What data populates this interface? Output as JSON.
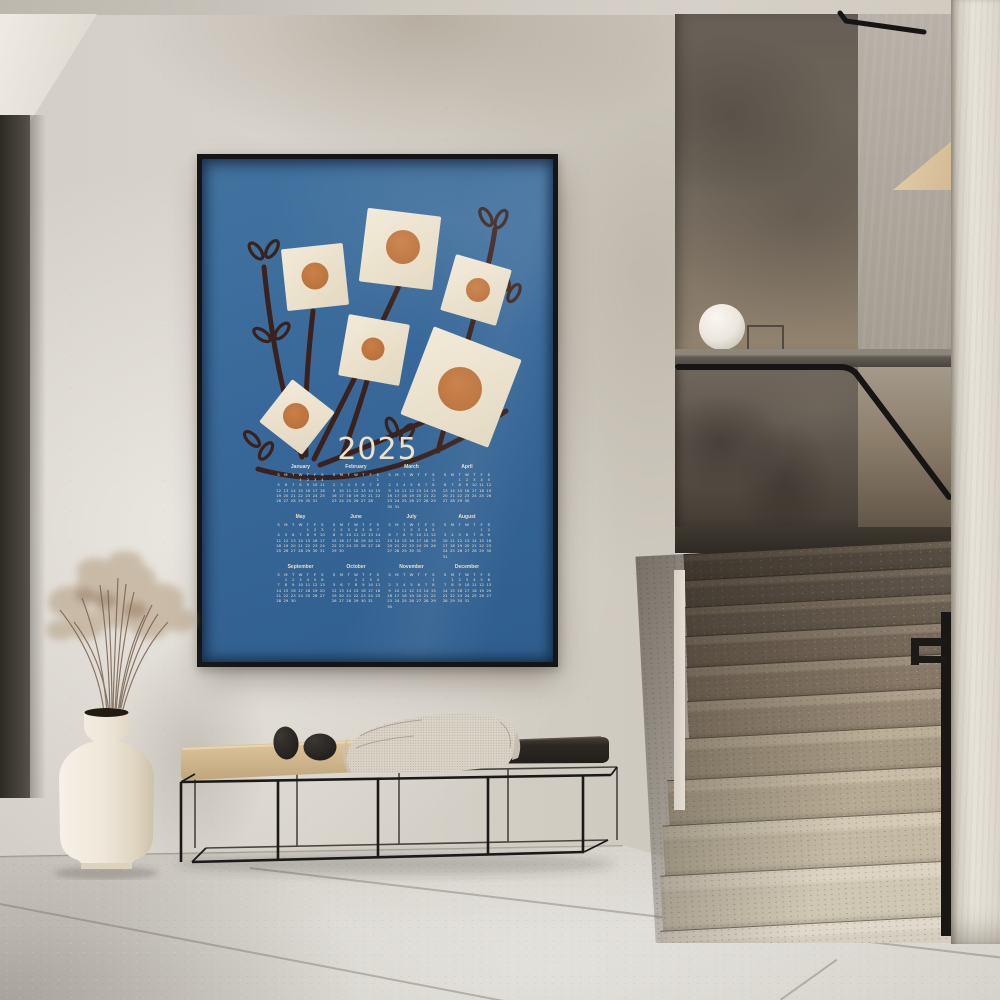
{
  "poster": {
    "title": "2025",
    "colors": {
      "poster_background": "#38699b",
      "flower_square": "#ece3d0",
      "flower_dot": "#c0763e",
      "branch": "#3a211b",
      "text": "#ece2cc",
      "frame": "#151518"
    },
    "calendar": {
      "day_headers": [
        "S",
        "M",
        "T",
        "W",
        "T",
        "F",
        "S"
      ],
      "months": [
        {
          "name": "January",
          "weeks": [
            [
              "",
              "",
              "",
              "1",
              "2",
              "3",
              "4"
            ],
            [
              "5",
              "6",
              "7",
              "8",
              "9",
              "10",
              "11"
            ],
            [
              "12",
              "13",
              "14",
              "15",
              "16",
              "17",
              "18"
            ],
            [
              "19",
              "20",
              "21",
              "22",
              "23",
              "24",
              "25"
            ],
            [
              "26",
              "27",
              "28",
              "29",
              "30",
              "31",
              ""
            ]
          ]
        },
        {
          "name": "February",
          "weeks": [
            [
              "",
              "",
              "",
              "",
              "",
              "",
              "1"
            ],
            [
              "2",
              "3",
              "4",
              "5",
              "6",
              "7",
              "8"
            ],
            [
              "9",
              "10",
              "11",
              "12",
              "13",
              "14",
              "15"
            ],
            [
              "16",
              "17",
              "18",
              "19",
              "20",
              "21",
              "22"
            ],
            [
              "23",
              "24",
              "25",
              "26",
              "27",
              "28",
              ""
            ]
          ]
        },
        {
          "name": "March",
          "weeks": [
            [
              "",
              "",
              "",
              "",
              "",
              "",
              "1"
            ],
            [
              "2",
              "3",
              "4",
              "5",
              "6",
              "7",
              "8"
            ],
            [
              "9",
              "10",
              "11",
              "12",
              "13",
              "14",
              "15"
            ],
            [
              "16",
              "17",
              "18",
              "19",
              "20",
              "21",
              "22"
            ],
            [
              "23",
              "24",
              "25",
              "26",
              "27",
              "28",
              "29"
            ],
            [
              "30",
              "31",
              "",
              "",
              "",
              "",
              ""
            ]
          ]
        },
        {
          "name": "April",
          "weeks": [
            [
              "",
              "",
              "1",
              "2",
              "3",
              "4",
              "5"
            ],
            [
              "6",
              "7",
              "8",
              "9",
              "10",
              "11",
              "12"
            ],
            [
              "13",
              "14",
              "15",
              "16",
              "17",
              "18",
              "19"
            ],
            [
              "20",
              "21",
              "22",
              "23",
              "24",
              "25",
              "26"
            ],
            [
              "27",
              "28",
              "29",
              "30",
              "",
              "",
              ""
            ]
          ]
        },
        {
          "name": "May",
          "weeks": [
            [
              "",
              "",
              "",
              "",
              "1",
              "2",
              "3"
            ],
            [
              "4",
              "5",
              "6",
              "7",
              "8",
              "9",
              "10"
            ],
            [
              "11",
              "12",
              "13",
              "14",
              "15",
              "16",
              "17"
            ],
            [
              "18",
              "19",
              "20",
              "21",
              "22",
              "23",
              "24"
            ],
            [
              "25",
              "26",
              "27",
              "28",
              "29",
              "30",
              "31"
            ]
          ]
        },
        {
          "name": "June",
          "weeks": [
            [
              "1",
              "2",
              "3",
              "4",
              "5",
              "6",
              "7"
            ],
            [
              "8",
              "9",
              "10",
              "11",
              "12",
              "13",
              "14"
            ],
            [
              "15",
              "16",
              "17",
              "18",
              "19",
              "20",
              "21"
            ],
            [
              "22",
              "23",
              "24",
              "25",
              "26",
              "27",
              "28"
            ],
            [
              "29",
              "30",
              "",
              "",
              "",
              "",
              ""
            ]
          ]
        },
        {
          "name": "July",
          "weeks": [
            [
              "",
              "",
              "1",
              "2",
              "3",
              "4",
              "5"
            ],
            [
              "6",
              "7",
              "8",
              "9",
              "10",
              "11",
              "12"
            ],
            [
              "13",
              "14",
              "15",
              "16",
              "17",
              "18",
              "19"
            ],
            [
              "20",
              "21",
              "22",
              "23",
              "24",
              "25",
              "26"
            ],
            [
              "27",
              "28",
              "29",
              "30",
              "31",
              "",
              ""
            ]
          ]
        },
        {
          "name": "August",
          "weeks": [
            [
              "",
              "",
              "",
              "",
              "",
              "1",
              "2"
            ],
            [
              "3",
              "4",
              "5",
              "6",
              "7",
              "8",
              "9"
            ],
            [
              "10",
              "11",
              "12",
              "13",
              "14",
              "15",
              "16"
            ],
            [
              "17",
              "18",
              "19",
              "20",
              "21",
              "22",
              "23"
            ],
            [
              "24",
              "25",
              "26",
              "27",
              "28",
              "29",
              "30"
            ],
            [
              "31",
              "",
              "",
              "",
              "",
              "",
              ""
            ]
          ]
        },
        {
          "name": "September",
          "weeks": [
            [
              "",
              "1",
              "2",
              "3",
              "4",
              "5",
              "6"
            ],
            [
              "7",
              "8",
              "9",
              "10",
              "11",
              "12",
              "13"
            ],
            [
              "14",
              "15",
              "16",
              "17",
              "18",
              "19",
              "20"
            ],
            [
              "21",
              "22",
              "23",
              "24",
              "25",
              "26",
              "27"
            ],
            [
              "28",
              "29",
              "30",
              "",
              "",
              "",
              ""
            ]
          ]
        },
        {
          "name": "October",
          "weeks": [
            [
              "",
              "",
              "",
              "1",
              "2",
              "3",
              "4"
            ],
            [
              "5",
              "6",
              "7",
              "8",
              "9",
              "10",
              "11"
            ],
            [
              "12",
              "13",
              "14",
              "15",
              "16",
              "17",
              "18"
            ],
            [
              "19",
              "20",
              "21",
              "22",
              "23",
              "24",
              "25"
            ],
            [
              "26",
              "27",
              "28",
              "29",
              "30",
              "31",
              ""
            ]
          ]
        },
        {
          "name": "November",
          "weeks": [
            [
              "",
              "",
              "",
              "",
              "",
              "",
              "1"
            ],
            [
              "2",
              "3",
              "4",
              "5",
              "6",
              "7",
              "8"
            ],
            [
              "9",
              "10",
              "11",
              "12",
              "13",
              "14",
              "15"
            ],
            [
              "16",
              "17",
              "18",
              "19",
              "20",
              "21",
              "22"
            ],
            [
              "23",
              "24",
              "25",
              "26",
              "27",
              "28",
              "29"
            ],
            [
              "30",
              "",
              "",
              "",
              "",
              "",
              ""
            ]
          ]
        },
        {
          "name": "December",
          "weeks": [
            [
              "",
              "1",
              "2",
              "3",
              "4",
              "5",
              "6"
            ],
            [
              "7",
              "8",
              "9",
              "10",
              "11",
              "12",
              "13"
            ],
            [
              "14",
              "15",
              "16",
              "17",
              "18",
              "19",
              "20"
            ],
            [
              "21",
              "22",
              "23",
              "24",
              "25",
              "26",
              "27"
            ],
            [
              "28",
              "29",
              "30",
              "31",
              "",
              "",
              ""
            ]
          ]
        }
      ]
    }
  }
}
